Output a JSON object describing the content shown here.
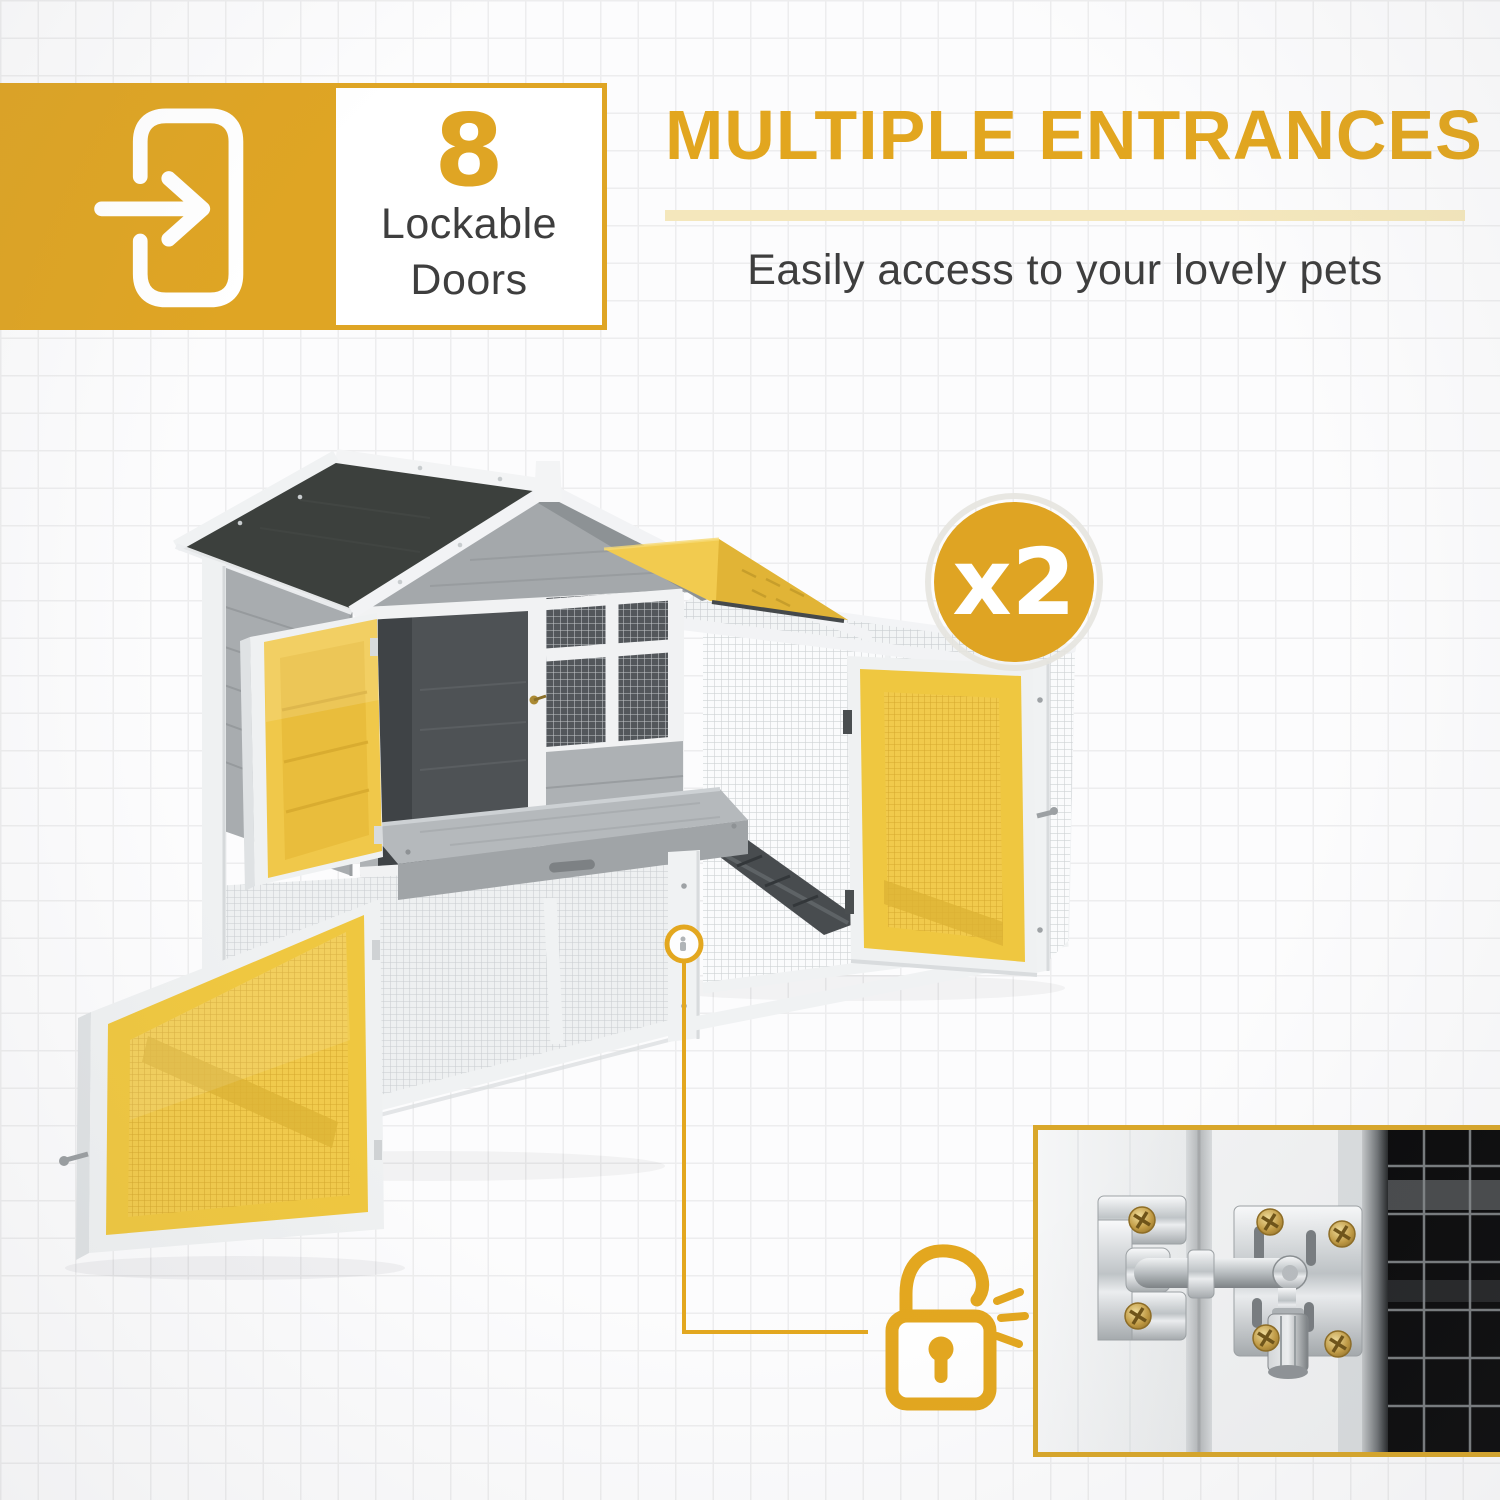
{
  "page": {
    "background_color": "#fcfcfd",
    "grid_line_color": "#ededee",
    "accent_color": "#e2a61f"
  },
  "feature_badge": {
    "icon": "door-enter-arrow-icon",
    "count": "8",
    "label_line1": "Lockable",
    "label_line2": "Doors"
  },
  "header": {
    "title": "MULTIPLE ENTRANCES",
    "subtitle": "Easily access to your lovely pets",
    "title_color": "#e2a61f",
    "subtitle_color": "#3e3e3e",
    "underline_color": "#f4e7bc"
  },
  "multiplier_badge": {
    "label": "x2",
    "circle_color": "#dfa423",
    "text_color": "#ffffff"
  },
  "lock_callout": {
    "icon": "padlock-unlocked-icon",
    "line_color": "#e3a71f"
  },
  "product_render": {
    "name": "pet-hutch-with-mesh-run",
    "highlight_color": "#f0c84a",
    "roof_color": "#3c403d",
    "siding_color": "#aeb2b5",
    "trim_color": "#f1f2f3",
    "highlighted_parts": [
      "upper-left-door",
      "lower-left-mesh-door",
      "run-front-mesh-door",
      "run-roof-flap"
    ]
  },
  "inset_photo": {
    "name": "lockable-latch-closeup-photo",
    "border_color": "#d9a72a"
  }
}
